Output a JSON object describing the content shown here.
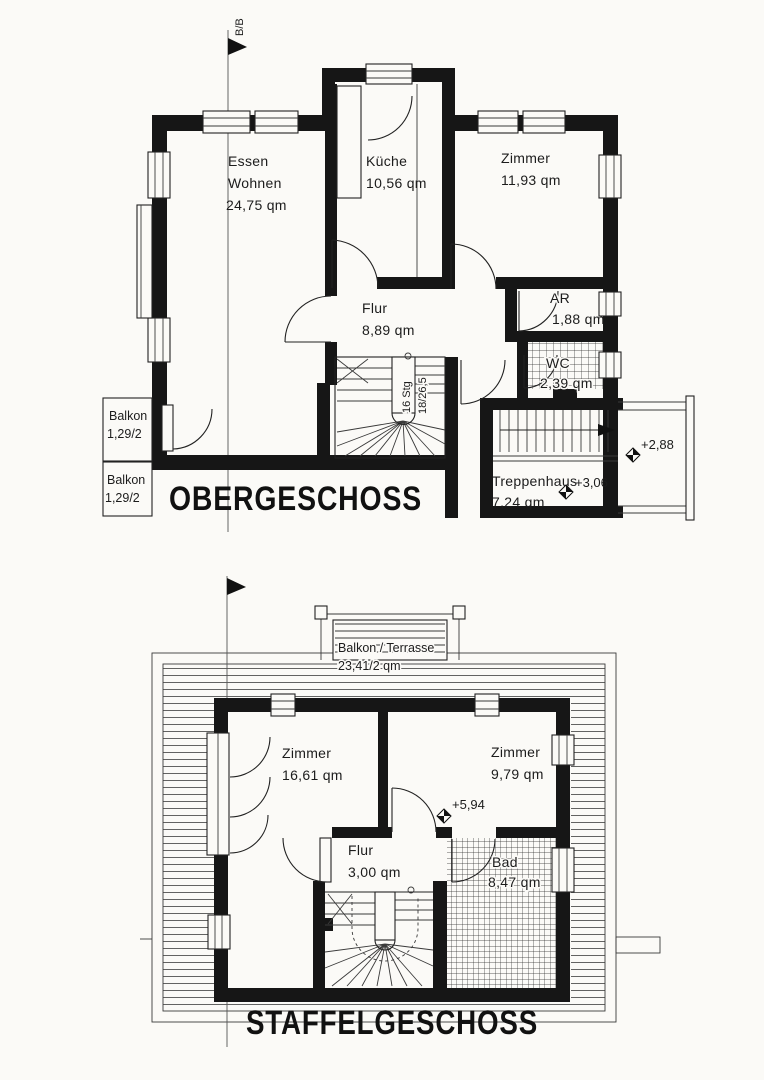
{
  "colors": {
    "ink": "#1c1c1c",
    "paper": "#fbfaf7",
    "wall": "#161616"
  },
  "section_marker": "B/B",
  "obergeschoss": {
    "title": "OBERGESCHOSS",
    "essen_wohnen": {
      "name1": "Essen",
      "name2": "Wohnen",
      "area": "24,75 qm"
    },
    "kueche": {
      "name": "Küche",
      "area": "10,56 qm"
    },
    "zimmer": {
      "name": "Zimmer",
      "area": "11,93 qm"
    },
    "flur": {
      "name": "Flur",
      "area": "8,89 qm"
    },
    "abstellraum": {
      "name": "AR",
      "area": "1,88 qm"
    },
    "wc": {
      "name": "WC",
      "area": "2,39 qm"
    },
    "treppenhaus": {
      "name": "Treppenhaus",
      "area": "7,24 qm"
    },
    "balkon_oben": {
      "name": "Balkon",
      "area": "1,29/2"
    },
    "balkon_unten": {
      "name": "Balkon",
      "area": "1,29/2"
    },
    "stair_note1": "16 Stg",
    "stair_note2": "18/26,5",
    "level_landing": "+2,88",
    "level_floor": "+3,06"
  },
  "staffelgeschoss": {
    "title": "STAFFELGESCHOSS",
    "balkon_terrasse": {
      "name": "Balkon / Terrasse",
      "area": "23,41/2 qm"
    },
    "zimmer_links": {
      "name": "Zimmer",
      "area": "16,61 qm"
    },
    "zimmer_rechts": {
      "name": "Zimmer",
      "area": "9,79 qm"
    },
    "flur": {
      "name": "Flur",
      "area": "3,00 qm"
    },
    "bad": {
      "name": "Bad",
      "area": "8,47 qm"
    },
    "level_floor": "+5,94"
  }
}
